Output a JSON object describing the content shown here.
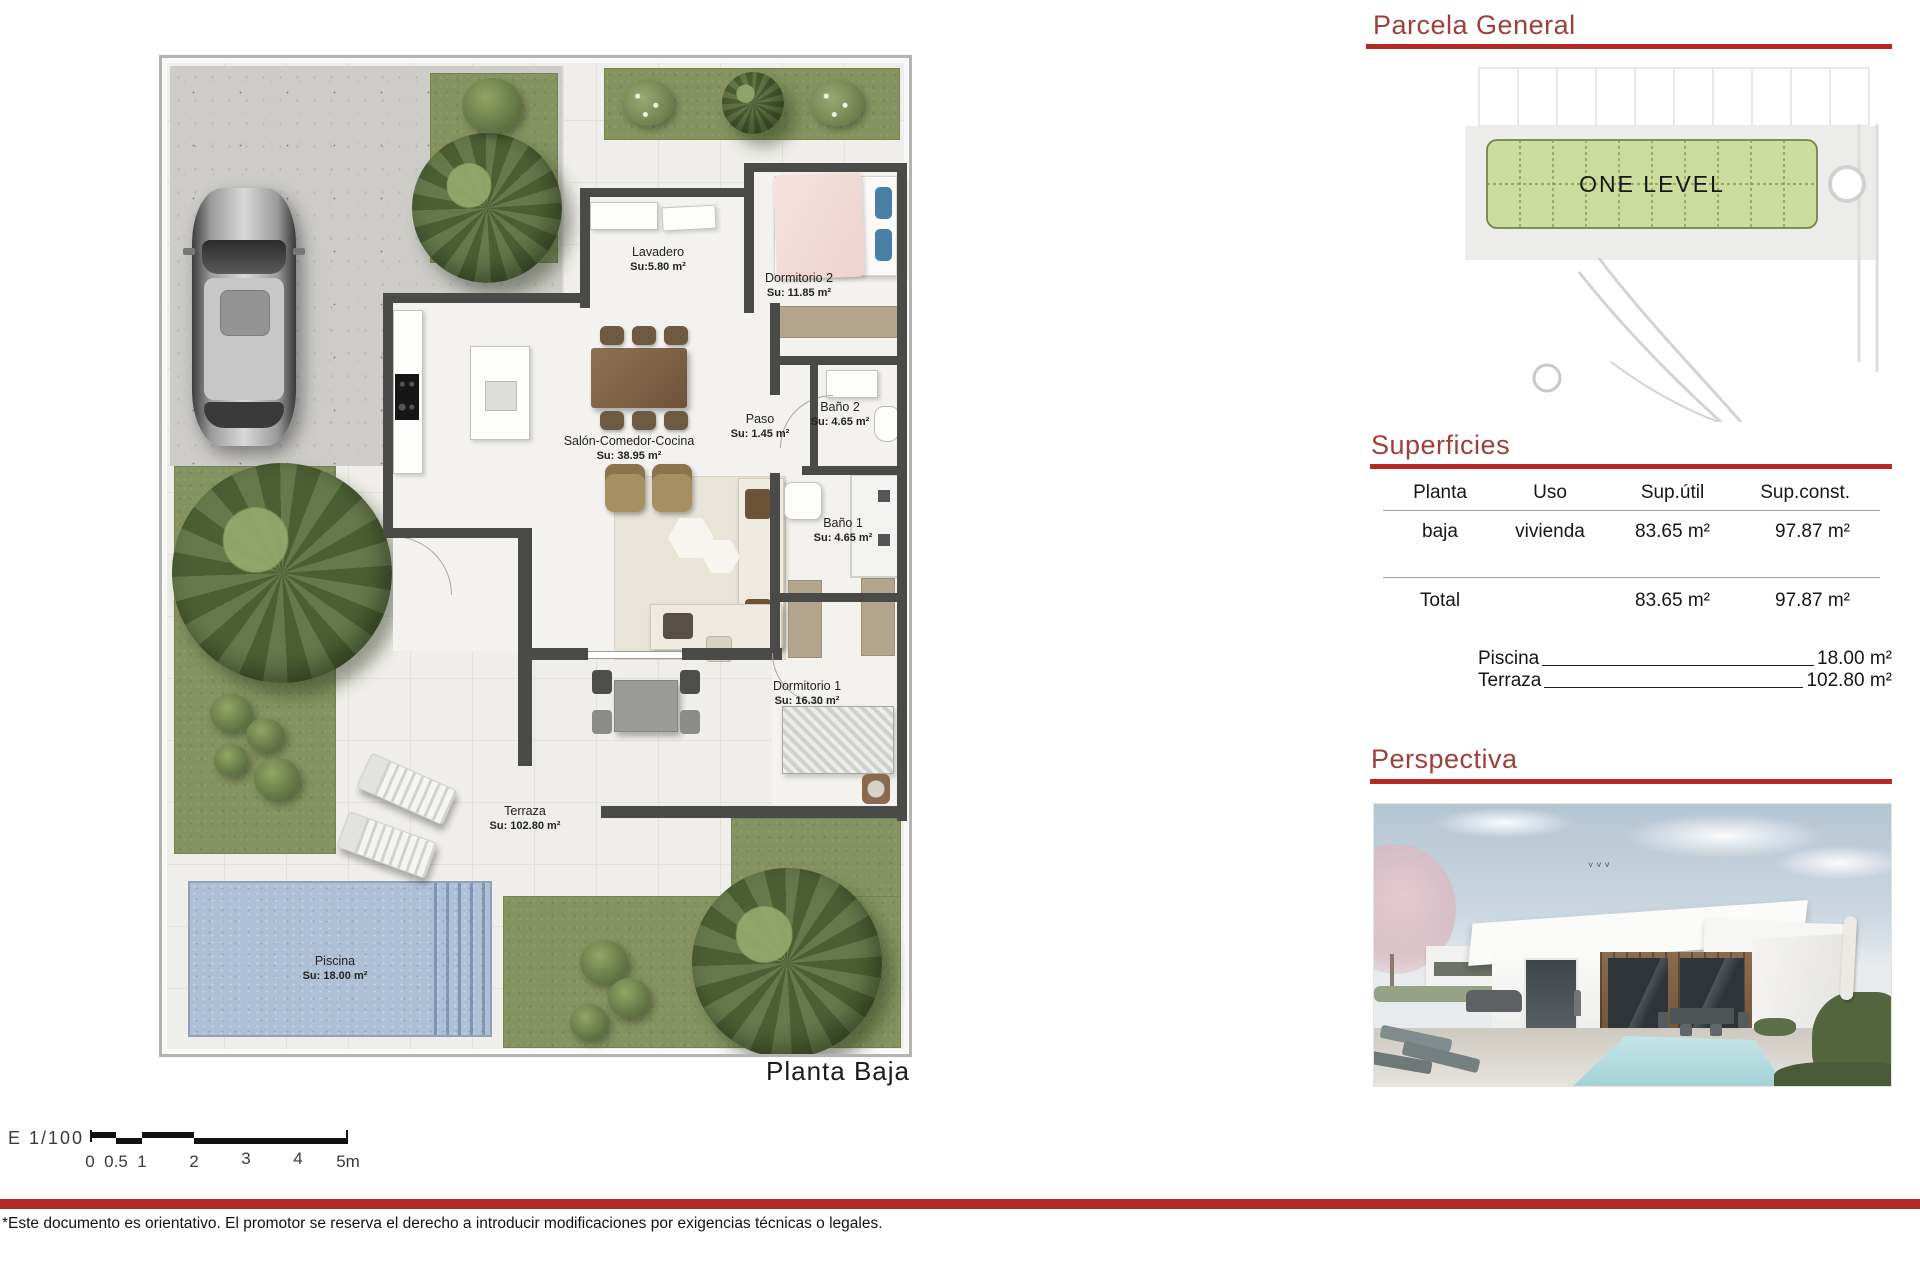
{
  "page": {
    "plan_label": "Planta  Baja",
    "footer_disclaimer": "*Este documento es orientativo. El promotor se reserva el derecho a introducir modificaciones por exigencias técnicas o legales."
  },
  "scalebar": {
    "label": "E  1/100",
    "ticks": [
      "0",
      "0.5",
      "1",
      "2",
      "3",
      "4",
      "5m"
    ]
  },
  "rooms": {
    "lavadero": {
      "name": "Lavadero",
      "area": "Su:5.80 m²"
    },
    "dormitorio2": {
      "name": "Dormitorio 2",
      "area": "Su: 11.85 m²"
    },
    "bano2": {
      "name": "Baño 2",
      "area": "Su: 4.65 m²"
    },
    "paso": {
      "name": "Paso",
      "area": "Su: 1.45 m²"
    },
    "salon": {
      "name": "Salón-Comedor-Cocina",
      "area": "Su: 38.95 m²"
    },
    "bano1": {
      "name": "Baño 1",
      "area": "Su: 4.65 m²"
    },
    "dormitorio1": {
      "name": "Dormitorio 1",
      "area": "Su: 16.30 m²"
    },
    "terraza": {
      "name": "Terraza",
      "area": "Su: 102.80 m²"
    },
    "piscina": {
      "name": "Piscina",
      "area": "Su: 18.00 m²"
    }
  },
  "parcela": {
    "title": "Parcela  General",
    "plot_label": "ONE LEVEL"
  },
  "superficies": {
    "title": "Superficies",
    "headers": [
      "Planta",
      "Uso",
      "Sup.útil",
      "Sup.const."
    ],
    "row": [
      "baja",
      "vivienda",
      "83.65 m²",
      "97.87 m²"
    ],
    "total_label": "Total",
    "total_util": "83.65 m²",
    "total_const": "97.87 m²",
    "extras": [
      {
        "label": "Piscina",
        "value": "18.00 m²"
      },
      {
        "label": "Terraza",
        "value": "102.80 m²"
      }
    ]
  },
  "perspectiva": {
    "title": "Perspectiva"
  },
  "colors": {
    "accent_text": "#9e3f3c",
    "accent_bar": "#b32a24"
  }
}
